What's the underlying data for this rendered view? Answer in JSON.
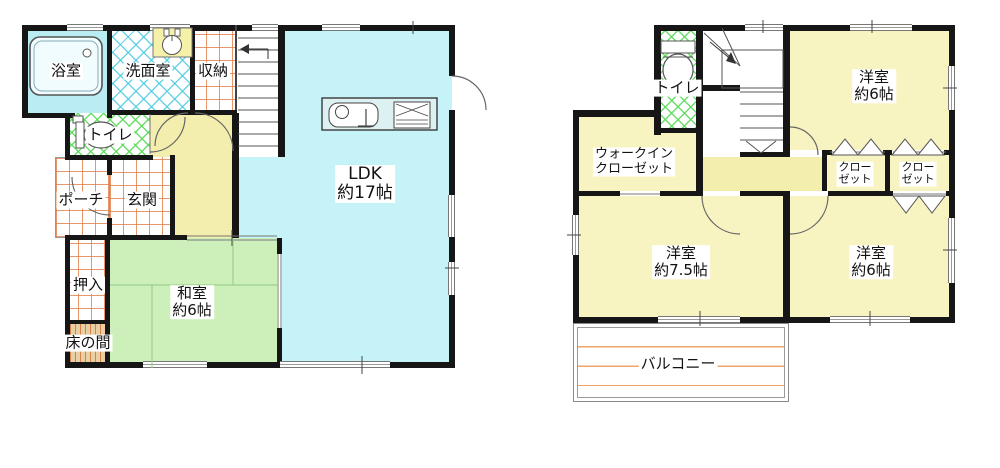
{
  "title": "2-story house floor plan",
  "colors": {
    "wall": "#161616",
    "ldk_fill": "#c5f3f8",
    "bath_fill": "#b9edf3",
    "tatami_fill": "#cdf0bb",
    "bedroom_fill": "#f8f4c2",
    "hall_fill": "#f3eeae",
    "tokonoma_fill": "#e9d0a4",
    "grid_line_orange": "#e17d46",
    "hatch_cyan": "#50cde1",
    "hatch_green": "#5adc5a",
    "balcony_line": "#f0a468"
  },
  "floor1": {
    "rooms": {
      "bathroom": {
        "label": "浴室"
      },
      "washroom": {
        "label": "洗面室"
      },
      "storage": {
        "label": "収納"
      },
      "toilet": {
        "label": "トイレ"
      },
      "porch": {
        "label": "ポーチ"
      },
      "entrance": {
        "label": "玄関"
      },
      "futon_closet": {
        "label": "押入"
      },
      "alcove": {
        "label": "床の間"
      },
      "japanese_room": {
        "name": "和室",
        "size": "約6帖"
      },
      "ldk": {
        "name": "LDK",
        "size": "約17帖"
      }
    }
  },
  "floor2": {
    "rooms": {
      "toilet": {
        "label": "トイレ"
      },
      "walk_in_closet": {
        "line1": "ウォークイン",
        "line2": "クローゼット"
      },
      "bedroom_north": {
        "name": "洋室",
        "size": "約6帖"
      },
      "closet_a": {
        "line1": "クロー",
        "line2": "ゼット"
      },
      "closet_b": {
        "line1": "クロー",
        "line2": "ゼット"
      },
      "bedroom_southwest": {
        "name": "洋室",
        "size": "約7.5帖"
      },
      "bedroom_southeast": {
        "name": "洋室",
        "size": "約6帖"
      },
      "balcony": {
        "label": "バルコニー"
      }
    }
  }
}
